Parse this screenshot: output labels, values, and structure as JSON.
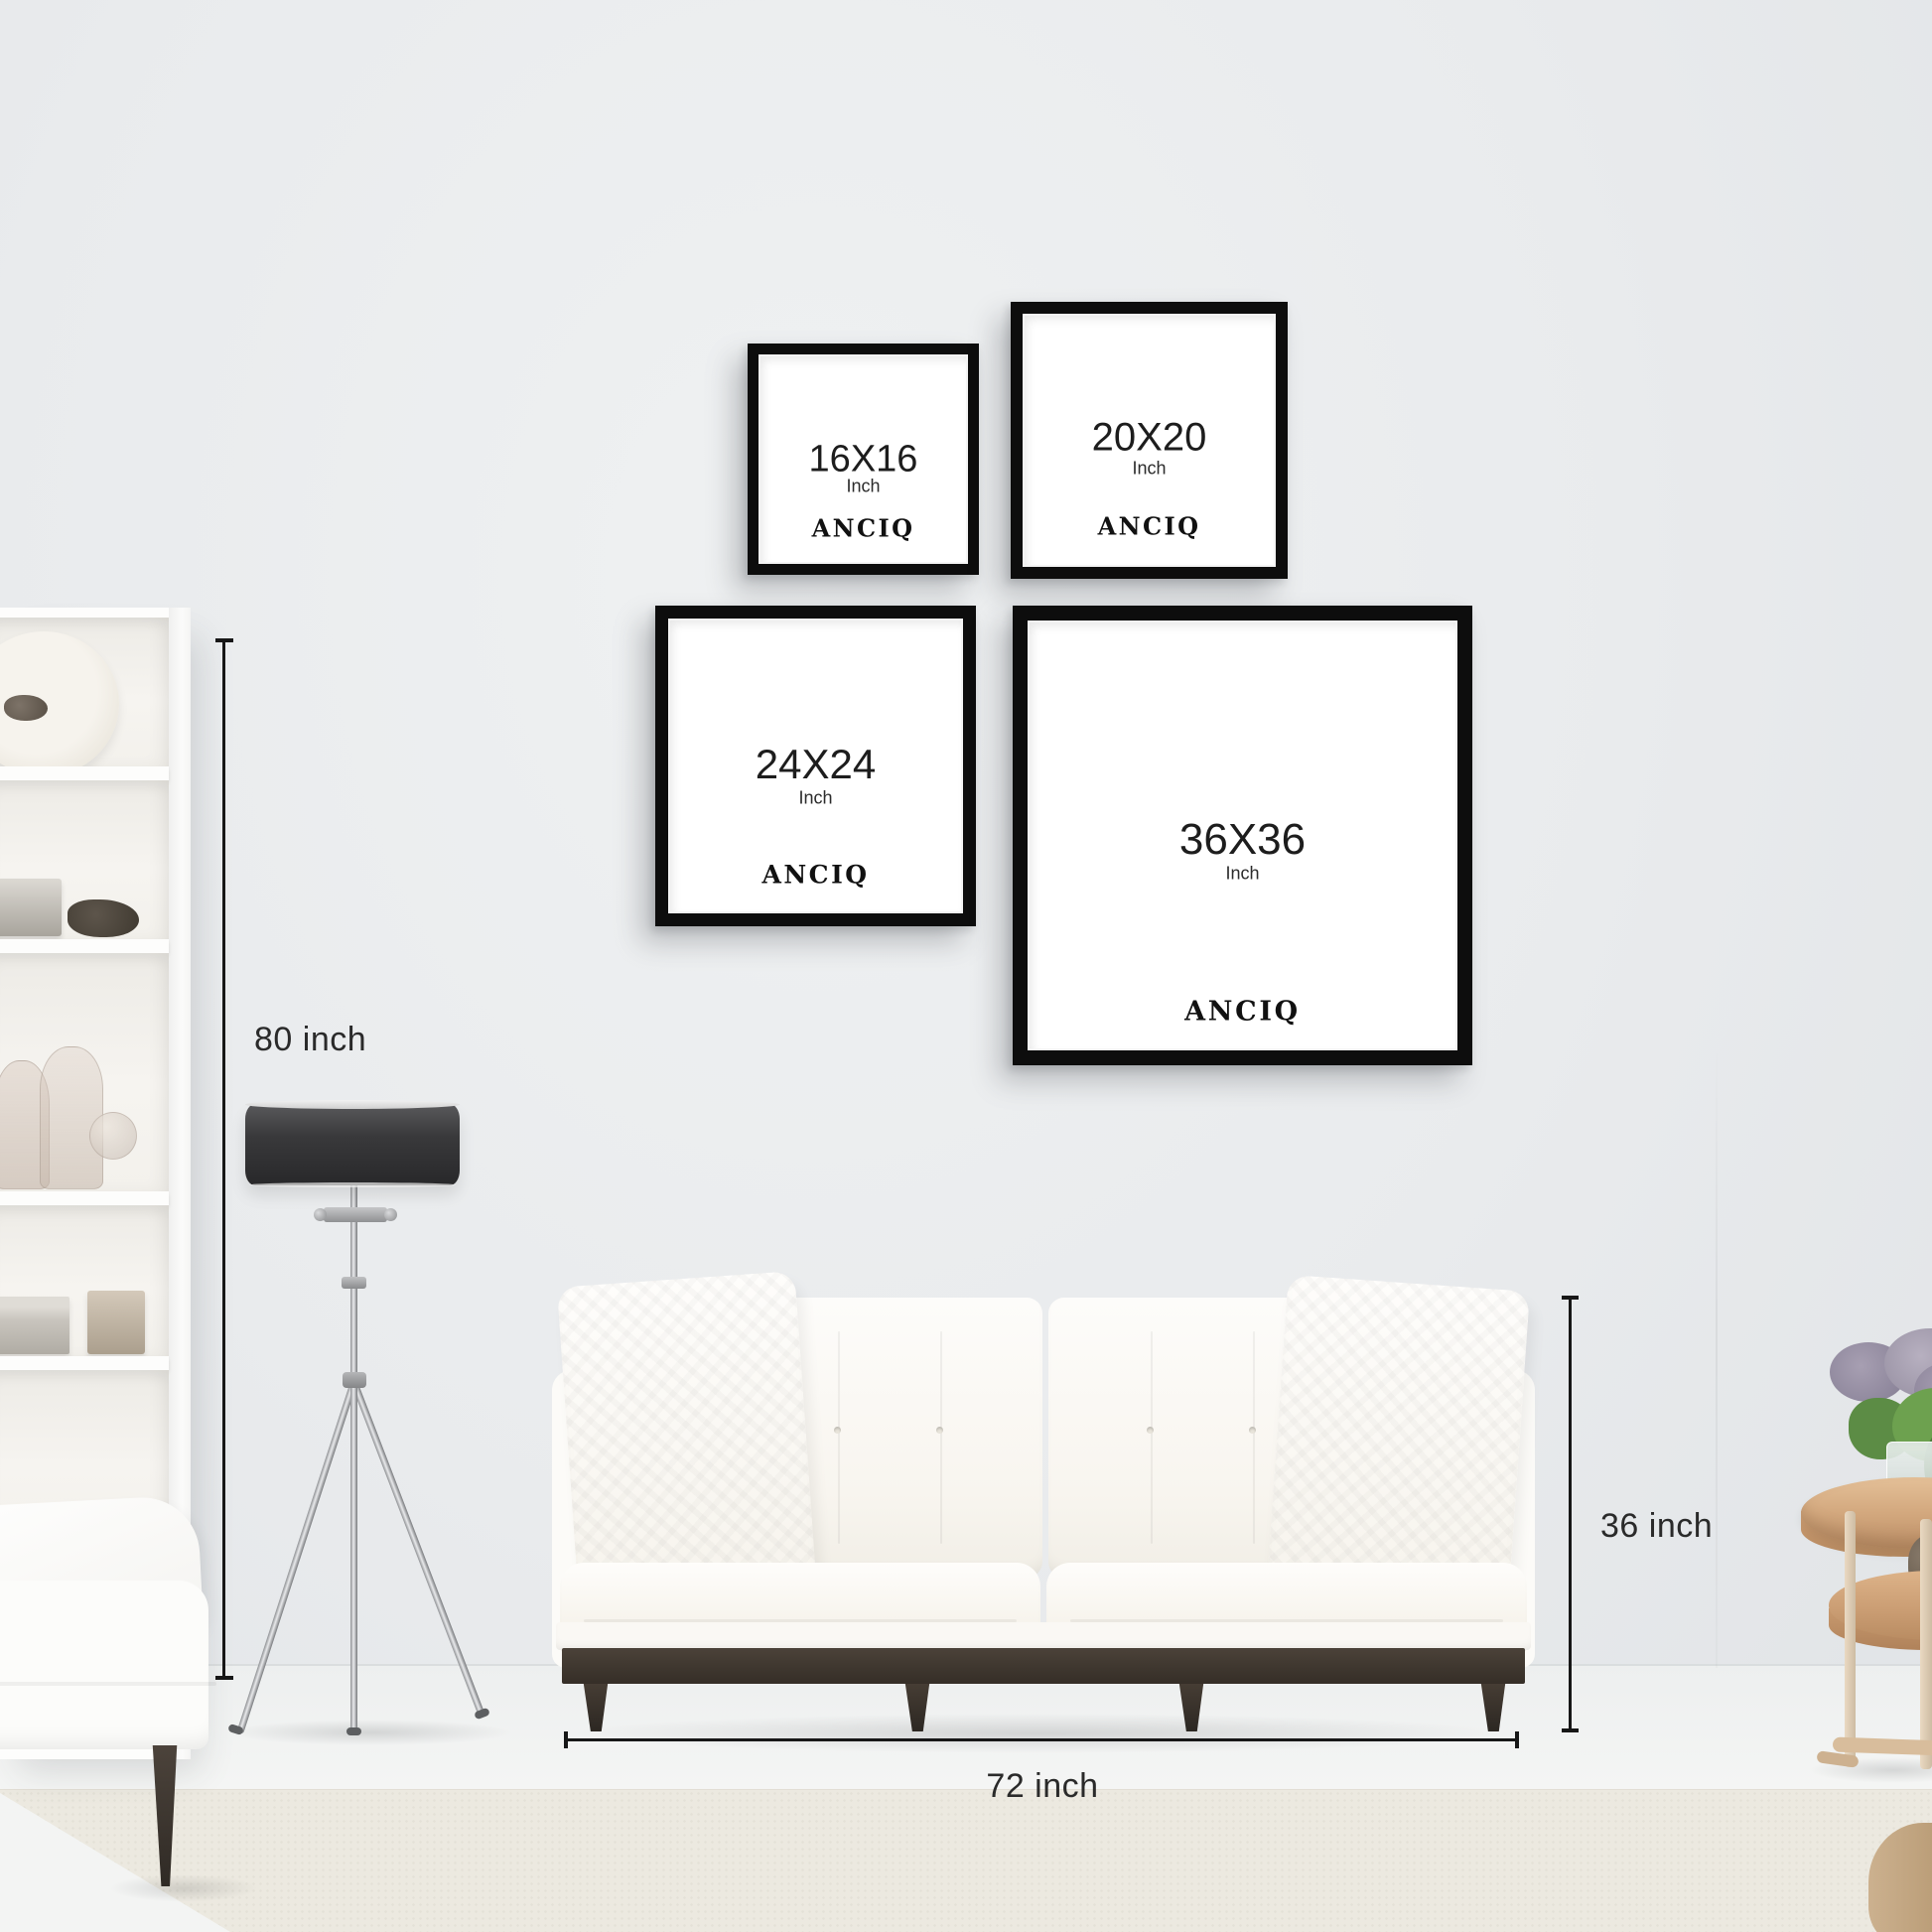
{
  "brand": "ANCIQ",
  "frames": [
    {
      "size": "16X16",
      "unit": "Inch",
      "logo": "ANCIQ"
    },
    {
      "size": "20X20",
      "unit": "Inch",
      "logo": "ANCIQ"
    },
    {
      "size": "24X24",
      "unit": "Inch",
      "logo": "ANCIQ"
    },
    {
      "size": "36X36",
      "unit": "Inch",
      "logo": "ANCIQ"
    }
  ],
  "annotations": {
    "wall_height_label": "80 inch",
    "sofa_height_label": "36 inch",
    "sofa_width_label": "72 inch"
  },
  "colors": {
    "wall": "#e9ebed",
    "frame_black": "#0d0d0d",
    "dimension_line": "#171717",
    "lamp_shade": "#39393b",
    "sofa": "#fbfaf6",
    "wood_leg": "#3a322b",
    "stool_wood": "#d3a87e",
    "carpet": "#ece9e0"
  }
}
